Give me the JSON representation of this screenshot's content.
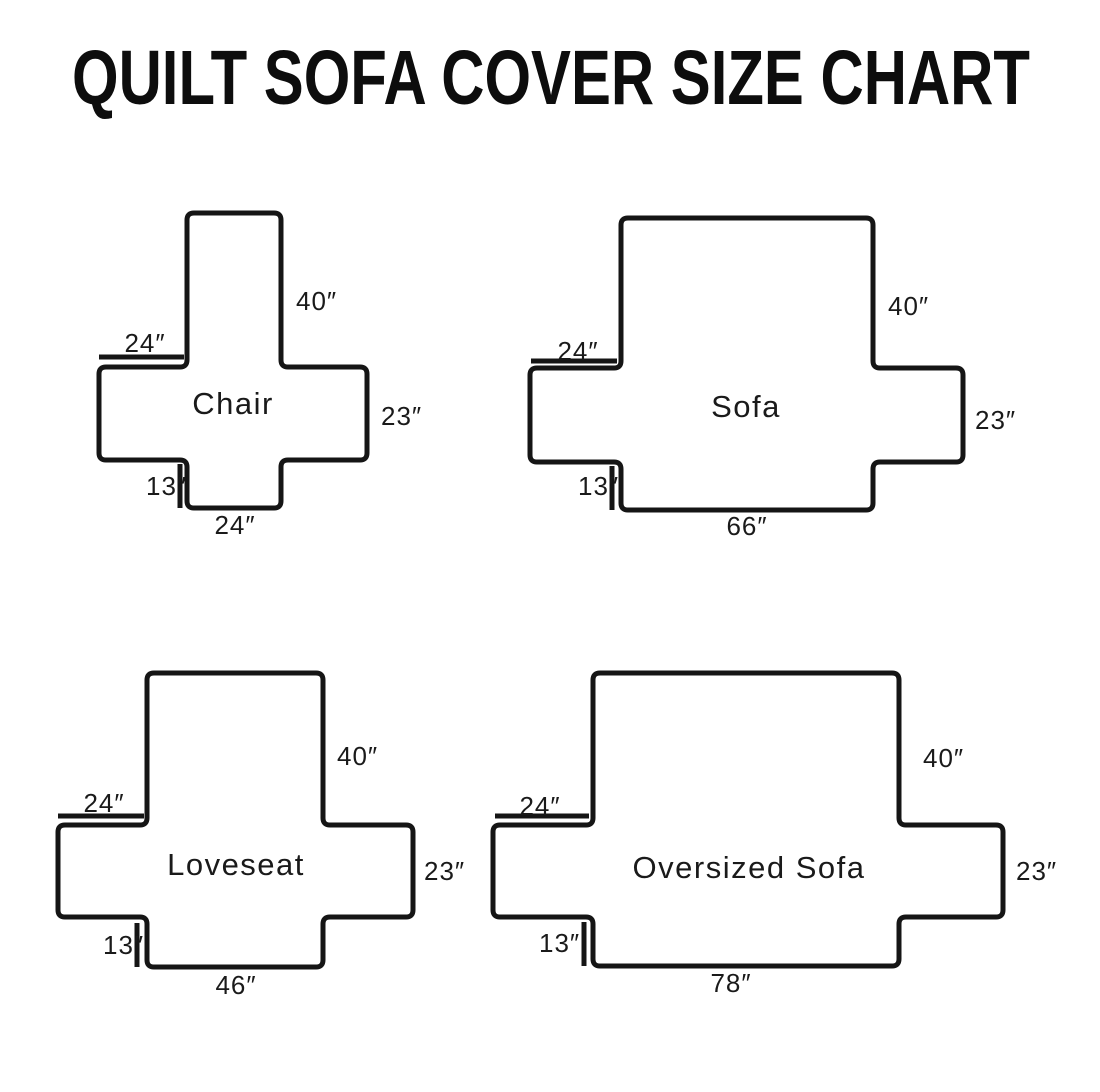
{
  "title": "QUILT SOFA COVER SIZE CHART",
  "colors": {
    "background": "#ffffff",
    "outline": "#151515",
    "text": "#1a1a1a"
  },
  "diagrams": [
    {
      "name": "Chair",
      "back_height": "40″",
      "arm_width": "24″",
      "side_height": "23″",
      "skirt_height": "13″",
      "bottom_width": "24″"
    },
    {
      "name": "Sofa",
      "back_height": "40″",
      "arm_width": "24″",
      "side_height": "23″",
      "skirt_height": "13″",
      "bottom_width": "66″"
    },
    {
      "name": "Loveseat",
      "back_height": "40″",
      "arm_width": "24″",
      "side_height": "23″",
      "skirt_height": "13″",
      "bottom_width": "46″"
    },
    {
      "name": "Oversized Sofa",
      "back_height": "40″",
      "arm_width": "24″",
      "side_height": "23″",
      "skirt_height": "13″",
      "bottom_width": "78″"
    }
  ]
}
